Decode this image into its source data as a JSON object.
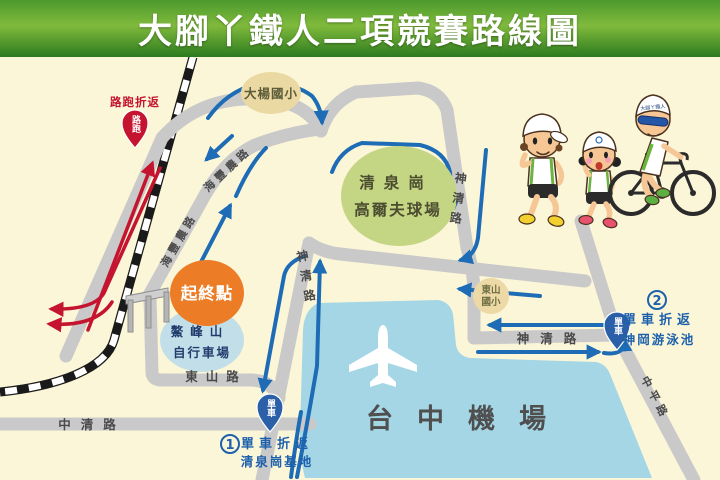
{
  "title": "大腳丫鐵人二項競賽路線圖",
  "colors": {
    "header_green_top": "#4c9a2d",
    "header_green_mid": "#80ba3c",
    "header_green_bottom": "#2c7a1f",
    "background_cream": "#fbf6d8",
    "road_gray": "#c9c9c9",
    "bike_route_blue": "#1d6cb5",
    "run_route_red": "#c41430",
    "airport_blue": "#a5d6e6",
    "golf_green": "#c4d584",
    "school_tan": "#ead9a2",
    "start_orange": "#ec7d26",
    "bike_field_blue": "#c2dfe9",
    "marker_pin_blue": "#2b5fa8"
  },
  "places": {
    "daya_school": "大楊國小",
    "golf": {
      "line1": "清泉崗",
      "line2": "高爾夫球場"
    },
    "start_finish": "起終點",
    "aofeng": {
      "line1": "鰲峰山",
      "line2": "自行車場"
    },
    "dongshan_school": {
      "line1": "東山",
      "line2": "國小"
    },
    "airport": "台中機場"
  },
  "roads": {
    "zhongqing": "中清路",
    "dongshan": "東山路",
    "shenqing": "神清路",
    "haifeng": "海豐農路",
    "zhongping": "中平路"
  },
  "markers": {
    "run": {
      "pin": "路跑",
      "note": "路跑折返"
    },
    "bike1": {
      "pin": "單車",
      "number": "1",
      "note_line1": "單車折返",
      "note_line2": "清泉崗基地"
    },
    "bike2": {
      "pin": "單車",
      "number": "2",
      "note_line1": "單車折返",
      "note_line2": "神岡游泳池"
    }
  },
  "illustrations": {
    "cyclist_cap_text": "大腳ㄚ鐵人"
  }
}
